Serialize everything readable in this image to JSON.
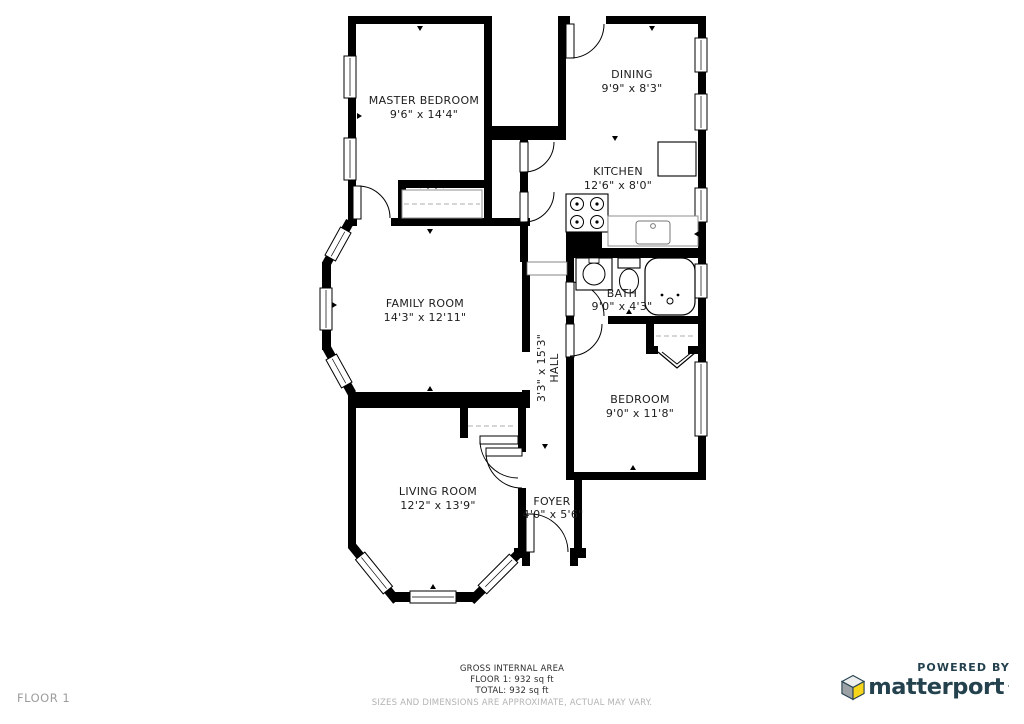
{
  "floor_plan": {
    "rooms": [
      {
        "id": "master-bedroom",
        "name": "MASTER BEDROOM",
        "dims": "9'6\" x 14'4\""
      },
      {
        "id": "dining",
        "name": "DINING",
        "dims": "9'9\" x 8'3\""
      },
      {
        "id": "kitchen",
        "name": "KITCHEN",
        "dims": "12'6\" x 8'0\""
      },
      {
        "id": "family-room",
        "name": "FAMILY ROOM",
        "dims": "14'3\" x 12'11\""
      },
      {
        "id": "bath",
        "name": "BATH",
        "dims": "9'0\" x 4'3\""
      },
      {
        "id": "hall",
        "name": "HALL",
        "dims": "3'3\" x 15'3\""
      },
      {
        "id": "bedroom",
        "name": "BEDROOM",
        "dims": "9'0\" x 11'8\""
      },
      {
        "id": "living-room",
        "name": "LIVING ROOM",
        "dims": "12'2\" x 13'9\""
      },
      {
        "id": "foyer",
        "name": "FOYER",
        "dims": "4'0\" x 5'6\""
      }
    ]
  },
  "footer": {
    "floor_label": "FLOOR 1",
    "area_heading": "GROSS INTERNAL AREA",
    "floor_area": "FLOOR 1: 932 sq ft",
    "total_area": "TOTAL: 932 sq ft",
    "disclaimer": "SIZES AND DIMENSIONS ARE APPROXIMATE, ACTUAL MAY VARY."
  },
  "branding": {
    "powered_by": "POWERED BY",
    "brand_name": "matterport",
    "trademark": "·"
  },
  "colors": {
    "wall": "#000000",
    "background": "#ffffff",
    "label_text": "#1c1c1c",
    "muted_text": "#9c9c9c",
    "brand_navy": "#24414e",
    "brand_yellow": "#f6d51a",
    "brand_gray": "#9ba1a4"
  }
}
